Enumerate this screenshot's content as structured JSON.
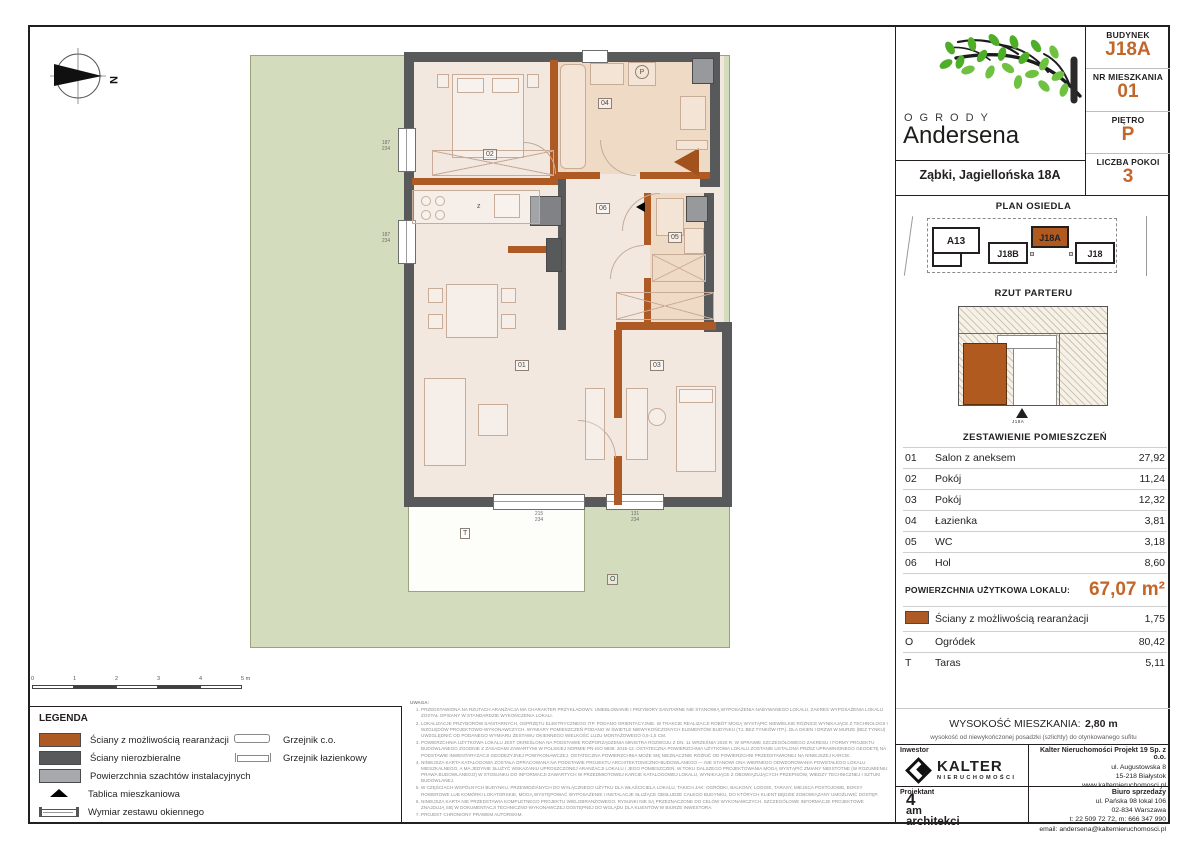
{
  "header": {
    "logo_line1": "OGRODY",
    "logo_line2": "Andersena",
    "address": "Ząbki, Jagiellońska 18A",
    "info": [
      {
        "label": "BUDYNEK",
        "value": "J18A"
      },
      {
        "label": "NR MIESZKANIA",
        "value": "01"
      },
      {
        "label": "PIĘTRO",
        "value": "P"
      },
      {
        "label": "LICZBA POKOI",
        "value": "3"
      }
    ]
  },
  "site_plan": {
    "title": "PLAN OSIEDLA",
    "buildings": [
      "A13",
      "J18B",
      "J18A",
      "J18"
    ],
    "highlighted": "J18A"
  },
  "floor_plan_thumb": {
    "title": "RZUT PARTERU",
    "marker": "J18A"
  },
  "rooms": {
    "title": "ZESTAWIENIE POMIESZCZEŃ",
    "rows": [
      {
        "no": "01",
        "name": "Salon z aneksem",
        "area": "27,92"
      },
      {
        "no": "02",
        "name": "Pokój",
        "area": "11,24"
      },
      {
        "no": "03",
        "name": "Pokój",
        "area": "12,32"
      },
      {
        "no": "04",
        "name": "Łazienka",
        "area": "3,81"
      },
      {
        "no": "05",
        "name": "WC",
        "area": "3,18"
      },
      {
        "no": "06",
        "name": "Hol",
        "area": "8,60"
      }
    ],
    "total_label": "POWIERZCHNIA UŻYTKOWA LOKALU:",
    "total_value": "67,07 m²",
    "extras": [
      {
        "sym": "",
        "name": "Ściany z możliwością rearanżacji",
        "area": "1,75"
      },
      {
        "sym": "O",
        "name": "Ogródek",
        "area": "80,42"
      },
      {
        "sym": "T",
        "name": "Taras",
        "area": "5,11"
      }
    ]
  },
  "height_info": {
    "label": "WYSOKOŚĆ MIESZKANIA:",
    "value": "2,80 m",
    "note": "wysokość od niewykończonej posadzki (szlichty) do otynkowanego sufitu"
  },
  "legend": {
    "title": "LEGENDA",
    "items": [
      "Ściany z możliwością rearanżacji",
      "Ściany nierozbieralne",
      "Powierzchnia szachtów instalacyjnych",
      "Tablica mieszkaniowa",
      "Wymiar zestawu okiennego",
      "Grzejnik c.o.",
      "Grzejnik łazienkowy"
    ]
  },
  "scalebar": {
    "ticks": [
      "0",
      "1",
      "2",
      "3",
      "4",
      "5 m"
    ]
  },
  "notes": {
    "title": "UWAGA:",
    "items": [
      "Przedstawiona na rzutach aranżacja ma charakter przykładowy. Umeblowanie i przybory sanitarne nie stanowią wyposażenia nabywanego lokalu. Zakres wyposażenia lokalu został opisany w standardzie wykończenia lokali.",
      "Lokalizacje przyborów sanitarnych, osprzętu elektrycznego itp. podano orientacyjnie. W trakcie realizacji robót mogą wystąpić niewielkie różnice wynikające z technologii i względów projektowo-wykonawczych. Wymiary pomieszczeń podano w świetle niewykończonych elementów budynku (tj. bez tynków itp.). Dla okien i drzwi w murze (bez tynku) uwzględnić od podanego wymiaru zestawu okiennego wielkość luzu montażowego 0,5-1,5 cm.",
      "Powierzchnia użytkowa lokalu jest określona na podstawie Rozporządzenia Ministra Rozwoju z dn. 11 września 2020 r. w sprawie szczegółowego zakresu i formy projektu budowlanego zgodnie z zasadami zawartymi w Polskiej Normie PN-ISO 9836: 2015-12. Ostateczna powierzchnia użytkowa lokalu zostanie ustalona przez uprawnionego geodetę na podstawie inwentaryzacji geodezyjnej powykonawczej. Ostateczna powierzchnia może się nieznacznie różnić od powierzchni przedstawionej na niniejszej karcie.",
      "Niniejsza karta katalogowa została opracowana na podstawie projektu architektoniczno-budowlanego — nie stanowi ona wiernego odwzorowania powstałego lokalu mieszkalnego, a ma jedynie służyć wskazaniu uproszczonej aranżacji lokalu i jego pomieszczeń. W toku dalszego projektowania mogą wystąpić zmiany nieistotne (w rozumieniu prawa budowlanego) w stosunku do informacji zawartych w przedmiotowej karcie katalogowej lokalu, wynikające z obowiązujących przepisów, wiedzy technicznej i sztuki budowlanej.",
      "W częściach wspólnych budynku, przewidzianych do wyłącznego użytku dla właściciela lokalu, takich jak: ogródki, balkony, loggie, tarasy, miejsca postojowe, boksy rowerowe lub komórki lokatorskie, mogą występować wyposażenie i instalacje służące obsłudze całego budynku, do których klient będzie zobowiązany umożliwić dostęp.",
      "Niniejsza karta nie przedstawia kompletnego projektu wielobranżowego. Rysunki nie są przeznaczone do celów wykonawczych. Szczegółowe informacje projektowe znajdują się w dokumentacji techniczno-wykonawczej dostępnej do wglądu dla klientów w biurze inwestora.",
      "Projekt chroniony prawem autorskim."
    ]
  },
  "plan": {
    "labels": {
      "r01": "01",
      "r02": "02",
      "r03": "03",
      "r04": "04",
      "r05": "05",
      "r06": "06",
      "taras": "T",
      "ogrodek": "O",
      "sink": "z",
      "washer": "P",
      "north": "N",
      "thumb_marker": "J18A"
    },
    "window_dims": {
      "left_top": "187\n234",
      "left_bottom": "187\n234",
      "bottom_salon": "215\n234",
      "bottom_room3": "131\n234"
    }
  },
  "footer": {
    "investor_label": "Inwestor",
    "designer_label": "Projektant",
    "kalter_logo_main": "KALTER",
    "kalter_logo_sub": "NIERUCHOMOŚCI",
    "company_name": "Kalter Nieruchomości Projekt 19 Sp. z o.o.",
    "company_lines": [
      "ul. Augustowska 8",
      "15-218 Białystok",
      "www.kalternieruchomosci.pl"
    ],
    "sales_label": "Biuro sprzedaży",
    "sales_lines": [
      "ul. Pańska 98 lokal 106",
      "02-834 Warszawa",
      "t: 22 509 72 72, m: 666 347 990",
      "email: andersena@kalternieruchomosci.pl"
    ],
    "designer_logo": [
      "4",
      "am",
      "architekci"
    ]
  }
}
